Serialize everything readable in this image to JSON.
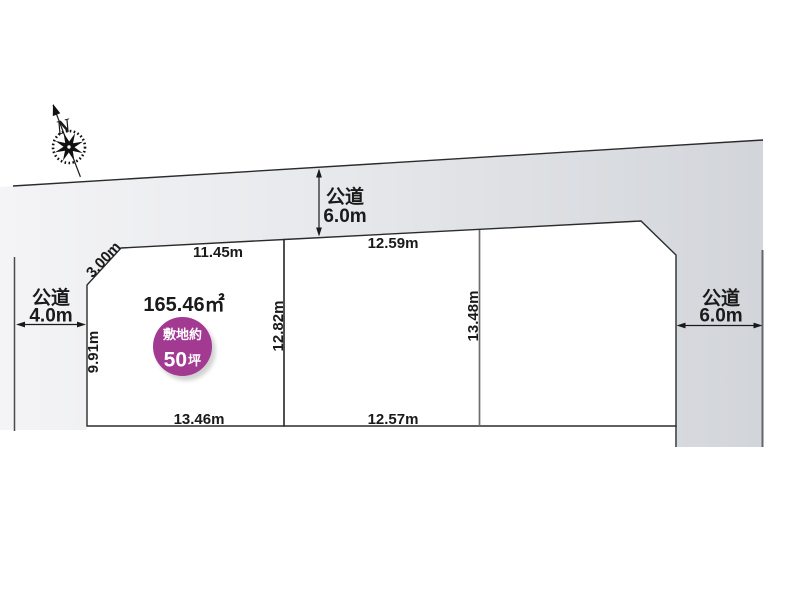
{
  "compass": {
    "north_label": "N"
  },
  "roads": {
    "top": {
      "label": "公道",
      "width": "6.0m"
    },
    "left": {
      "label": "公道",
      "width": "4.0m"
    },
    "right": {
      "label": "公道",
      "width": "6.0m"
    }
  },
  "main_plot": {
    "area_label": "165.46㎡",
    "badge": {
      "line1": "敷地約",
      "value": "50",
      "unit": "坪"
    },
    "dims": {
      "top": "11.45m",
      "corner": "3.00m",
      "left": "9.91m",
      "right": "12.82m",
      "bottom": "13.46m"
    },
    "fill_center": "#f0f2dc",
    "fill_edge": "#c9ce8d",
    "badge_color": "#a23a92"
  },
  "adjacent_plot": {
    "dims": {
      "top": "12.59m",
      "bottom": "12.57m",
      "divider": "13.48m"
    }
  },
  "colors": {
    "road_light": "#f4f4f6",
    "road_dark": "#d2d5da",
    "line": "#2b2b2b"
  }
}
